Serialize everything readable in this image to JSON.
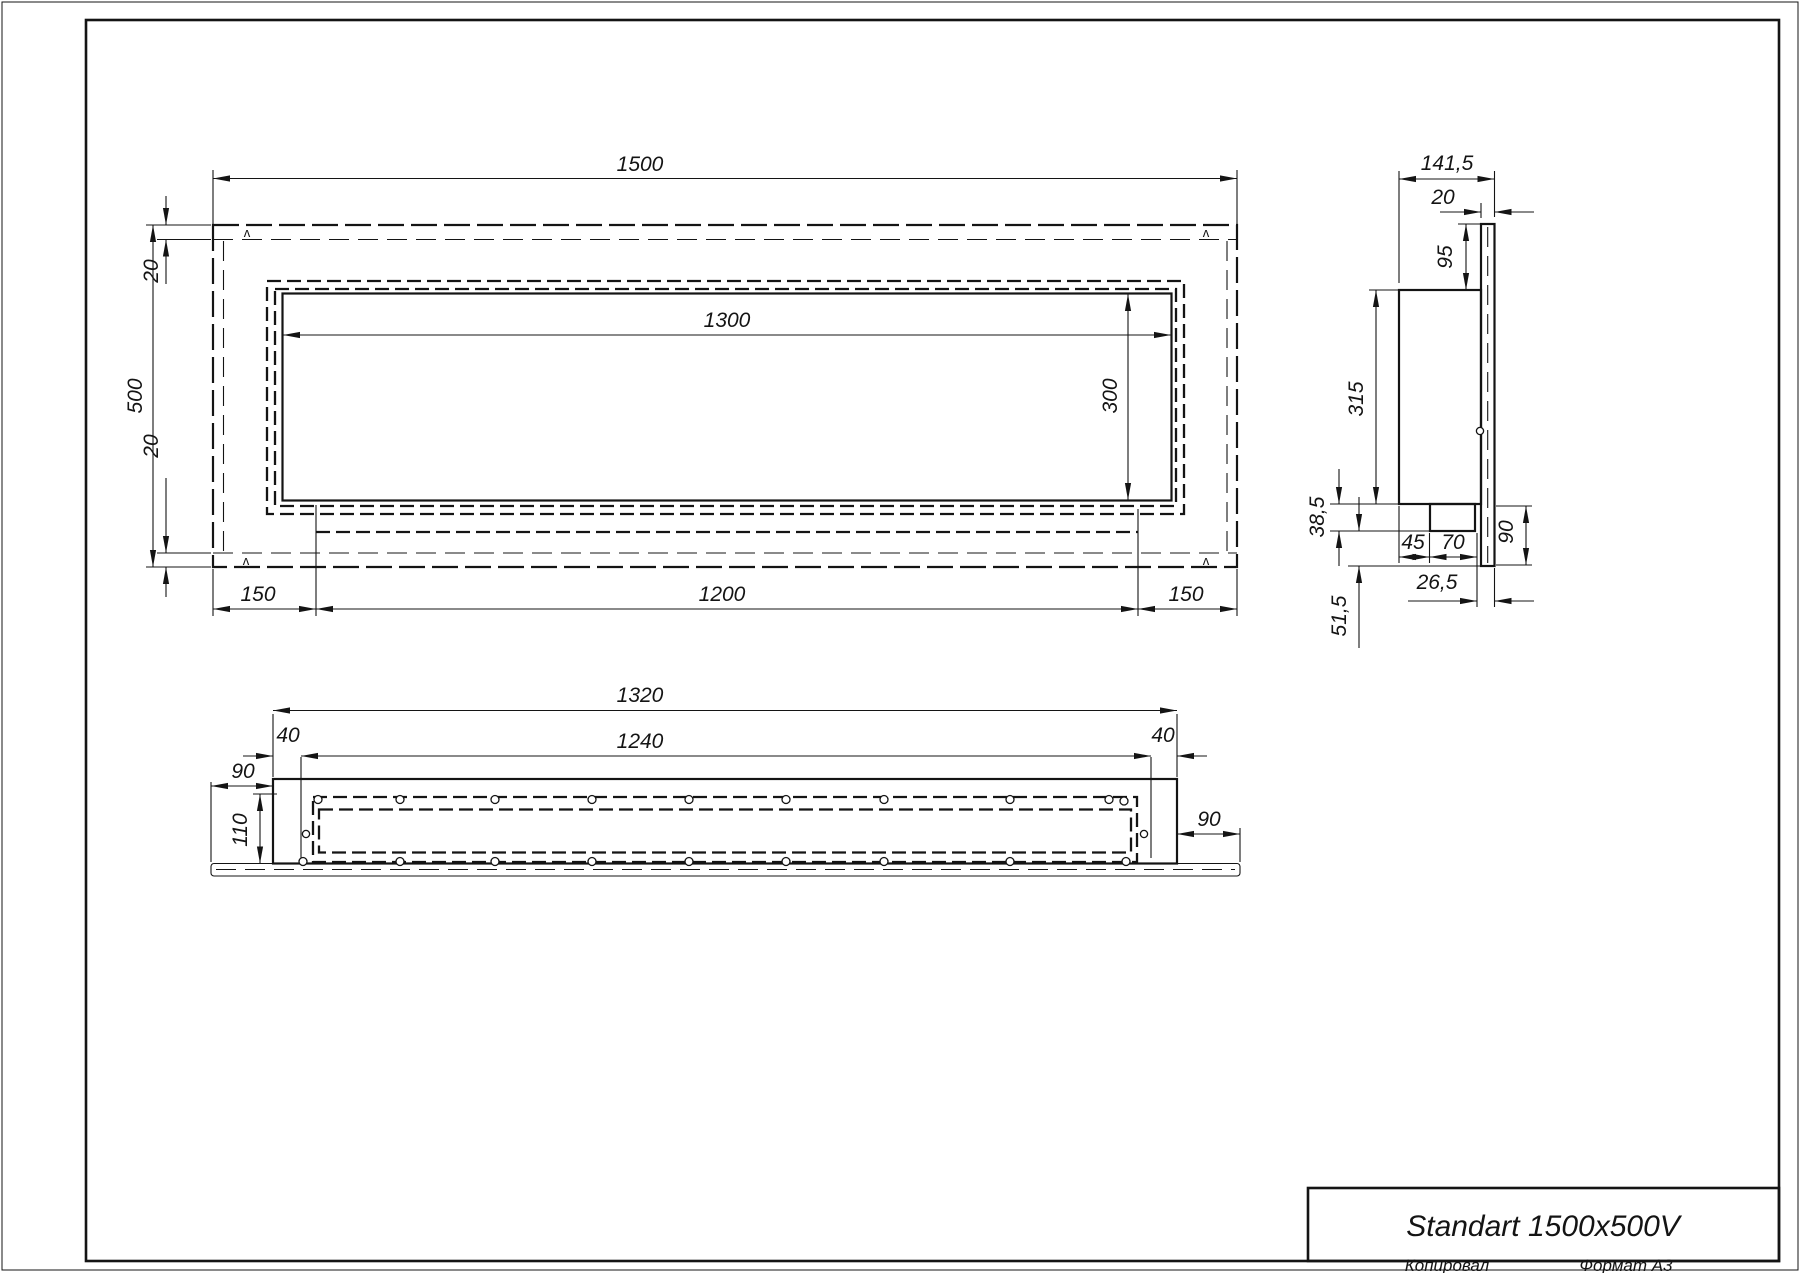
{
  "title_block": {
    "title": "Standart 1500x500V",
    "copied_by_label": "Копировал",
    "format_label": "Формат А3"
  },
  "front_view": {
    "weld_mark": "ʌ",
    "dims": {
      "overall_width": "1500",
      "overall_height": "500",
      "top_inset": "20",
      "bottom_inset": "20",
      "opening_width": "1300",
      "opening_height": "300",
      "left_margin": "150",
      "burner_width": "1200",
      "right_margin": "150"
    }
  },
  "side_view": {
    "dims": {
      "overall_depth": "141,5",
      "front_flange_depth": "20",
      "top_recess": "95",
      "body_height": "315",
      "bottom_recess": "38,5",
      "foot_inset": "45",
      "foot_depth": "70",
      "lower_front_height": "90",
      "foot_to_front_gap": "26,5",
      "lower_recess": "51,5"
    }
  },
  "bottom_view": {
    "dims": {
      "box_length": "1320",
      "inner_length": "1240",
      "left_wall": "40",
      "right_wall": "40",
      "left_overhang": "90",
      "box_depth": "110",
      "right_overhang": "90"
    }
  }
}
